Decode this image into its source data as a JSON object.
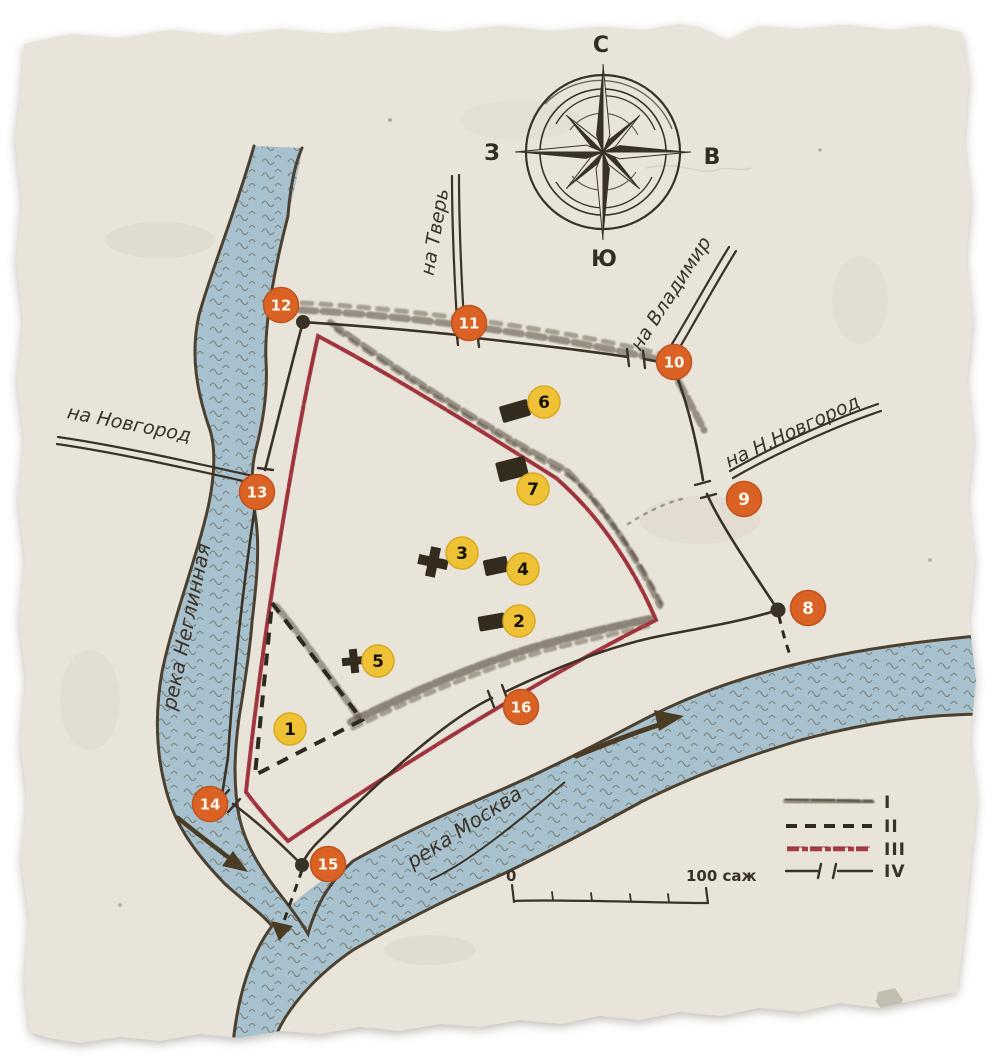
{
  "colors": {
    "paper": "#e9e4d9",
    "ink": "#3b3227",
    "wall_red": "#a83b42",
    "river_fill": "#a7c2ce",
    "river_ink": "#4c4130",
    "marker_orange": "#d96224",
    "marker_yellow": "#efc236",
    "building": "#332c1e"
  },
  "compass": {
    "north": "С",
    "south": "Ю",
    "east": "В",
    "west": "З"
  },
  "roads": {
    "tver": "на Тверь",
    "vladimir": "на Владимир",
    "nizhny": "на Н.Новгород",
    "novgorod": "на Новгород"
  },
  "rivers": {
    "neglinnaya": "река Неглинная",
    "moskva": "река Москва"
  },
  "legend": {
    "item1": "I",
    "item2": "II",
    "item3": "III",
    "item4": "IV"
  },
  "scale": {
    "zero": "0",
    "hundred": "100 саж"
  },
  "markers": [
    {
      "n": 1,
      "kind": "yellow",
      "x": 290,
      "y": 729
    },
    {
      "n": 2,
      "kind": "yellow",
      "x": 519,
      "y": 621
    },
    {
      "n": 3,
      "kind": "yellow",
      "x": 462,
      "y": 553
    },
    {
      "n": 4,
      "kind": "yellow",
      "x": 523,
      "y": 569
    },
    {
      "n": 5,
      "kind": "yellow",
      "x": 378,
      "y": 661
    },
    {
      "n": 6,
      "kind": "yellow",
      "x": 544,
      "y": 402
    },
    {
      "n": 7,
      "kind": "yellow",
      "x": 533,
      "y": 489
    },
    {
      "n": 8,
      "kind": "orange",
      "x": 808,
      "y": 608
    },
    {
      "n": 9,
      "kind": "orange",
      "x": 744,
      "y": 499
    },
    {
      "n": 10,
      "kind": "orange",
      "x": 674,
      "y": 362
    },
    {
      "n": 11,
      "kind": "orange",
      "x": 469,
      "y": 323
    },
    {
      "n": 12,
      "kind": "orange",
      "x": 281,
      "y": 305
    },
    {
      "n": 13,
      "kind": "orange",
      "x": 257,
      "y": 492
    },
    {
      "n": 14,
      "kind": "orange",
      "x": 210,
      "y": 804
    },
    {
      "n": 15,
      "kind": "orange",
      "x": 328,
      "y": 864
    },
    {
      "n": 16,
      "kind": "orange",
      "x": 521,
      "y": 707
    }
  ],
  "buildings": [
    {
      "n": 2,
      "type": "rect",
      "x": 492,
      "y": 622,
      "w": 27,
      "h": 15,
      "rot": -10
    },
    {
      "n": 3,
      "type": "church",
      "x": 433,
      "y": 562,
      "s": 1.25,
      "rot": 12
    },
    {
      "n": 4,
      "type": "rect",
      "x": 496,
      "y": 566,
      "w": 24,
      "h": 16,
      "rot": -12
    },
    {
      "n": 5,
      "type": "church",
      "x": 354,
      "y": 661,
      "s": 1.0,
      "rot": -6
    },
    {
      "n": 6,
      "type": "rect",
      "x": 515,
      "y": 411,
      "w": 29,
      "h": 17,
      "rot": -16
    },
    {
      "n": 7,
      "type": "rect",
      "x": 512,
      "y": 469,
      "w": 30,
      "h": 20,
      "rot": -14
    }
  ]
}
